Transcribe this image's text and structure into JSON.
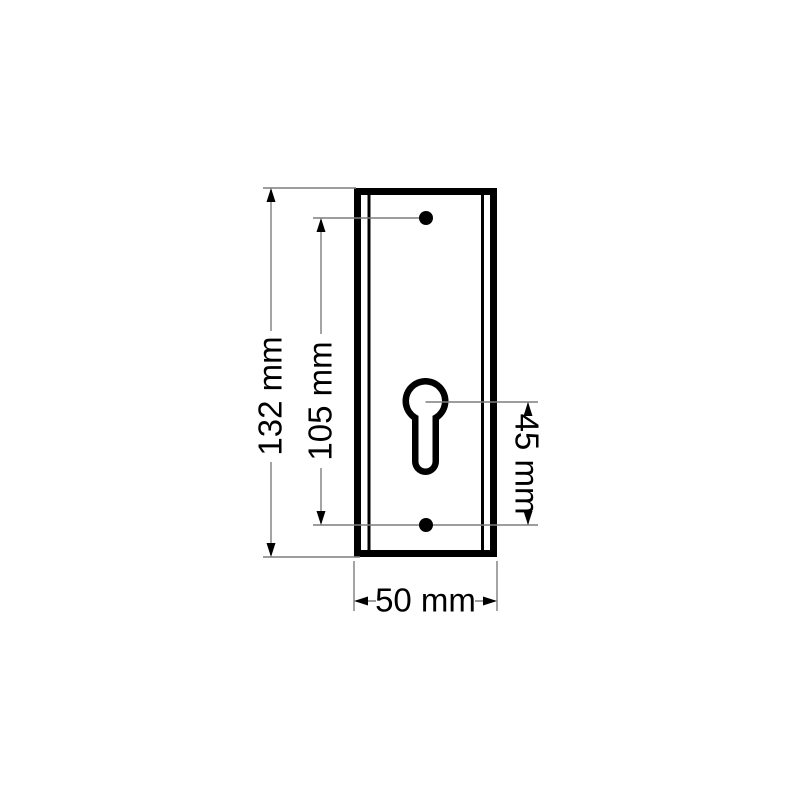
{
  "drawing": {
    "dimensions": {
      "overall_height": {
        "label": "132 mm",
        "value_mm": 132
      },
      "screw_hole_spacing": {
        "label": "105 mm",
        "value_mm": 105
      },
      "cylinder_to_screw_hole": {
        "label": "45 mm",
        "value_mm": 45
      },
      "overall_width": {
        "label": "50 mm",
        "value_mm": 50
      }
    },
    "colors": {
      "background": "#ffffff",
      "drawing_lines": "#000000",
      "dimension_lines": "#7d7d7d"
    }
  }
}
